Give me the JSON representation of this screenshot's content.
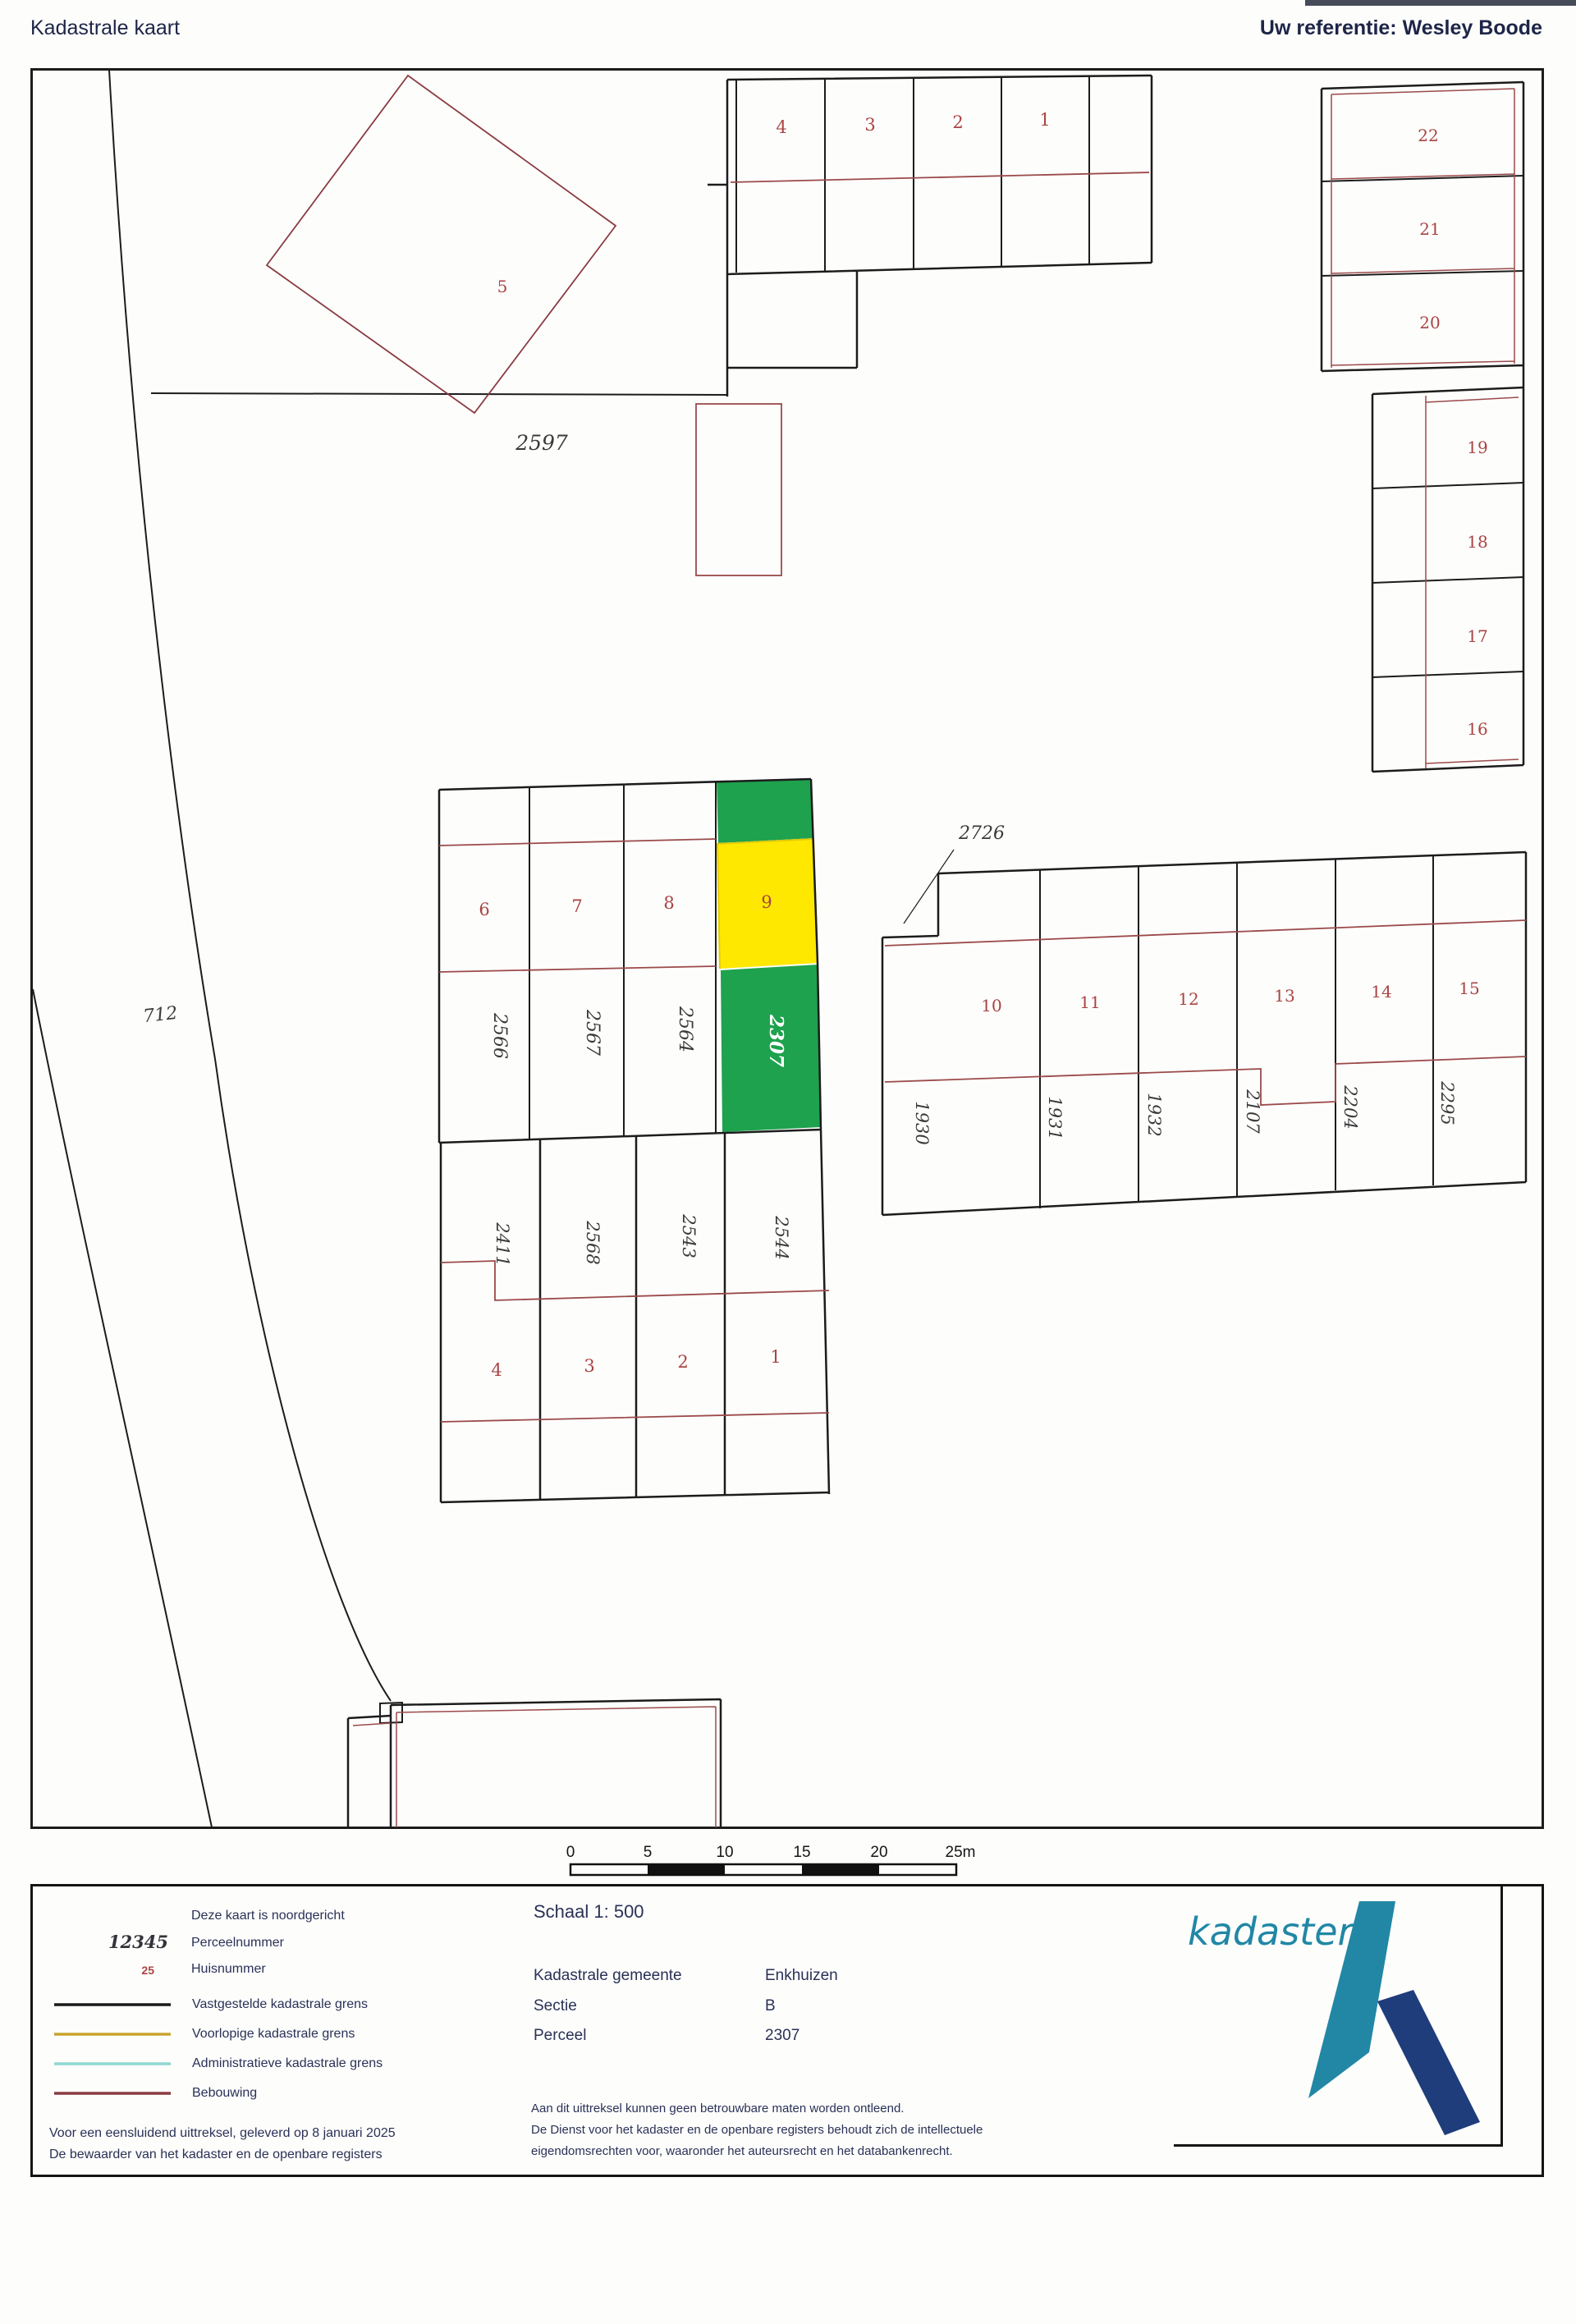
{
  "header": {
    "title": "Kadastrale kaart",
    "reference": "Uw referentie: Wesley Boode"
  },
  "map": {
    "road_parcel": "712",
    "parcel_5": {
      "huisnummer": "5",
      "perceelnummer": "2597"
    },
    "north_strip": {
      "huisnummers": [
        "4",
        "3",
        "2",
        "1"
      ]
    },
    "center_block": {
      "huisnummers": [
        "6",
        "7",
        "8",
        "9"
      ],
      "perceelnummers": [
        "2566",
        "2567",
        "2564",
        "2307"
      ]
    },
    "east_block": {
      "area_label": "2726",
      "huisnummers": [
        "10",
        "11",
        "12",
        "13",
        "14",
        "15"
      ],
      "perceelnummers": [
        "1930",
        "1931",
        "1932",
        "2107",
        "2204",
        "2295"
      ]
    },
    "south_block": {
      "perceelnummers": [
        "2411",
        "2568",
        "2543",
        "2544"
      ],
      "huisnummers": [
        "4",
        "3",
        "2",
        "1"
      ]
    },
    "northeast_upper": {
      "huisnummers": [
        "22",
        "21",
        "20"
      ]
    },
    "northeast_lower": {
      "huisnummers": [
        "19",
        "18",
        "17",
        "16"
      ]
    },
    "highlight": {
      "parcel": "2307",
      "fill_green": "#1ea24d",
      "fill_yellow": "#ffe800"
    }
  },
  "scalebar": {
    "labels": [
      "0",
      "5",
      "10",
      "15",
      "20",
      "25m"
    ]
  },
  "legend": {
    "north_note": "Deze kaart is noordgericht",
    "parcel_sample": "12345",
    "parcel_label": "Perceelnummer",
    "house_sample": "25",
    "house_label": "Huisnummer",
    "lines": [
      {
        "label": "Vastgestelde kadastrale grens",
        "color": "#1a1a1a"
      },
      {
        "label": "Voorlopige kadastrale grens",
        "color": "#c9a32e"
      },
      {
        "label": "Administratieve kadastrale grens",
        "color": "#8fd8d2"
      },
      {
        "label": "Bebouwing",
        "color": "#8a3b41"
      }
    ],
    "footnote1": "Voor een eensluidend uittreksel, geleverd op 8 januari 2025",
    "footnote2": "De bewaarder van het kadaster en de openbare registers"
  },
  "details": {
    "scale": "Schaal 1: 500",
    "rows": [
      {
        "label": "Kadastrale gemeente",
        "value": "Enkhuizen"
      },
      {
        "label": "Sectie",
        "value": "B"
      },
      {
        "label": "Perceel",
        "value": "2307"
      }
    ],
    "disclaimer1": "Aan dit uittreksel kunnen geen betrouwbare maten worden ontleend.",
    "disclaimer2": "De Dienst voor het kadaster en de openbare registers behoudt zich de intellectuele",
    "disclaimer3": "eigendomsrechten voor, waaronder het auteursrecht en het databankenrecht."
  },
  "logo": {
    "text": "kadaster",
    "teal": "#2187a5",
    "navy": "#1f3d7a"
  }
}
